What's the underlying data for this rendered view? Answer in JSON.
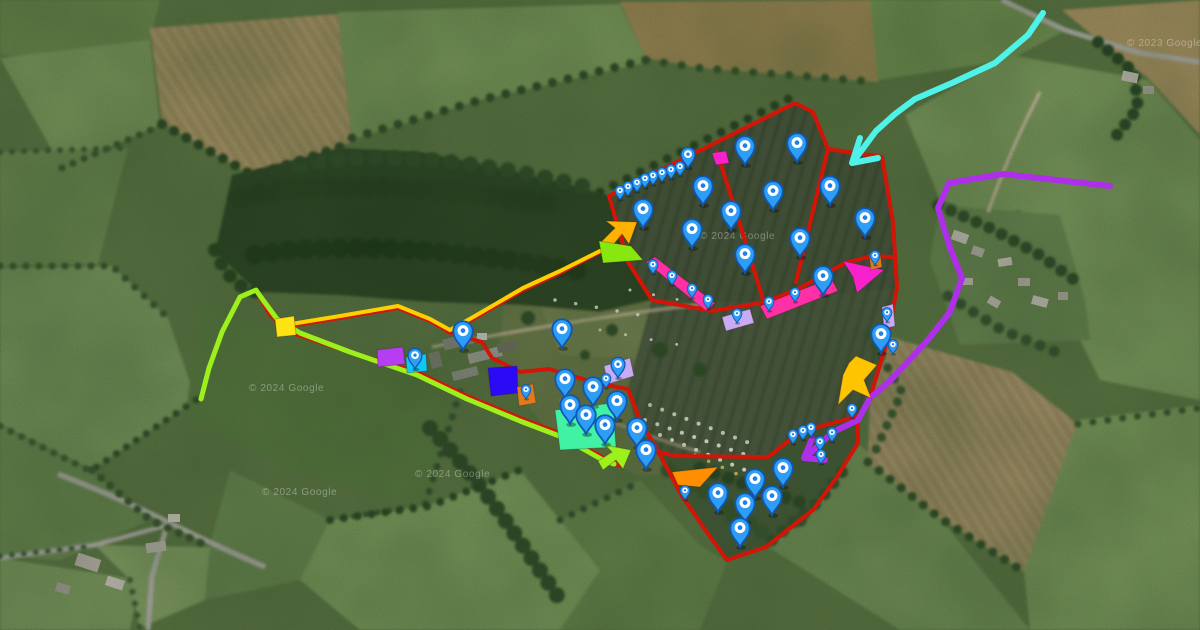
{
  "map": {
    "watermarks": [
      {
        "text": "© 2024 Google",
        "x": 249,
        "y": 391
      },
      {
        "text": "© 2024 Google",
        "x": 415,
        "y": 477
      },
      {
        "text": "© 2024 Google",
        "x": 700,
        "y": 239
      },
      {
        "text": "© 2024 Google",
        "x": 262,
        "y": 495
      },
      {
        "text": "© 2023 Google",
        "x": 1127,
        "y": 46
      }
    ],
    "watermark_color": "#ffffff",
    "routes": [
      {
        "id": "boundary-main-field",
        "color": "#d21507",
        "width": 4,
        "points": [
          [
            609,
            196
          ],
          [
            795,
            103
          ],
          [
            813,
            112
          ],
          [
            828,
            149
          ],
          [
            882,
            157
          ],
          [
            893,
            222
          ],
          [
            897,
            288
          ],
          [
            886,
            345
          ],
          [
            870,
            398
          ],
          [
            858,
            421
          ]
        ]
      },
      {
        "id": "boundary-left-edge",
        "color": "#d21507",
        "width": 4,
        "points": [
          [
            609,
            196
          ],
          [
            628,
            262
          ],
          [
            652,
            300
          ]
        ]
      },
      {
        "id": "boundary-divider-west",
        "color": "#d21507",
        "width": 4,
        "points": [
          [
            717,
            152
          ],
          [
            748,
            250
          ],
          [
            764,
            303
          ]
        ]
      },
      {
        "id": "boundary-divider-east",
        "color": "#d21507",
        "width": 4,
        "points": [
          [
            828,
            149
          ],
          [
            812,
            215
          ],
          [
            796,
            282
          ]
        ]
      },
      {
        "id": "boundary-belt",
        "color": "#d21507",
        "width": 4,
        "points": [
          [
            652,
            300
          ],
          [
            712,
            311
          ],
          [
            766,
            302
          ],
          [
            800,
            288
          ],
          [
            845,
            263
          ],
          [
            872,
            256
          ],
          [
            893,
            257
          ]
        ]
      },
      {
        "id": "boundary-access-north",
        "color": "#d21507",
        "width": 4,
        "points": [
          [
            257,
            292
          ],
          [
            270,
            315
          ],
          [
            283,
            327
          ],
          [
            340,
            318
          ],
          [
            398,
            308
          ],
          [
            430,
            321
          ],
          [
            450,
            332
          ],
          [
            475,
            318
          ],
          [
            523,
            290
          ],
          [
            560,
            273
          ],
          [
            598,
            253
          ],
          [
            616,
            245
          ]
        ]
      },
      {
        "id": "boundary-farm-south",
        "color": "#d21507",
        "width": 4,
        "points": [
          [
            283,
            330
          ],
          [
            340,
            349
          ],
          [
            417,
            372
          ],
          [
            467,
            396
          ],
          [
            520,
            418
          ],
          [
            562,
            434
          ],
          [
            600,
            456
          ],
          [
            620,
            466
          ]
        ]
      },
      {
        "id": "boundary-farm-east",
        "color": "#d21507",
        "width": 4,
        "points": [
          [
            448,
            332
          ],
          [
            482,
            342
          ],
          [
            492,
            358
          ],
          [
            520,
            372
          ],
          [
            549,
            369
          ],
          [
            600,
            384
          ],
          [
            628,
            389
          ],
          [
            640,
            420
          ],
          [
            660,
            455
          ],
          [
            682,
            496
          ],
          [
            706,
            531
          ],
          [
            727,
            560
          ],
          [
            766,
            547
          ],
          [
            790,
            528
          ],
          [
            813,
            510
          ],
          [
            837,
            477
          ],
          [
            858,
            443
          ],
          [
            858,
            418
          ]
        ]
      },
      {
        "id": "boundary-lower-field-top",
        "color": "#d21507",
        "width": 4,
        "points": [
          [
            640,
            447
          ],
          [
            675,
            456
          ],
          [
            768,
            457
          ],
          [
            800,
            432
          ],
          [
            858,
            416
          ]
        ]
      },
      {
        "id": "route-cyan",
        "color": "#4ff2e9",
        "width": 6,
        "points": [
          [
            1043,
            13
          ],
          [
            1028,
            35
          ],
          [
            995,
            63
          ],
          [
            952,
            83
          ],
          [
            915,
            99
          ],
          [
            895,
            114
          ],
          [
            876,
            131
          ],
          [
            856,
            158
          ]
        ],
        "head": [
          [
            860,
            138
          ],
          [
            852,
            163
          ],
          [
            878,
            158
          ]
        ]
      },
      {
        "id": "route-purple",
        "color": "#ad2fe9",
        "width": 6,
        "points": [
          [
            1110,
            186
          ],
          [
            1003,
            174
          ],
          [
            949,
            183
          ],
          [
            938,
            208
          ],
          [
            950,
            248
          ],
          [
            962,
            278
          ],
          [
            950,
            312
          ],
          [
            927,
            341
          ],
          [
            890,
            381
          ],
          [
            870,
            398
          ],
          [
            858,
            420
          ],
          [
            833,
            432
          ],
          [
            808,
            455
          ]
        ],
        "head": [
          [
            812,
            439
          ],
          [
            804,
            458
          ],
          [
            825,
            460
          ]
        ]
      },
      {
        "id": "route-yellow",
        "color": "#ffd000",
        "width": 4,
        "points": [
          [
            285,
            325
          ],
          [
            340,
            316
          ],
          [
            398,
            306
          ],
          [
            430,
            319
          ],
          [
            450,
            330
          ],
          [
            475,
            316
          ],
          [
            523,
            288
          ],
          [
            560,
            271
          ],
          [
            600,
            251
          ]
        ]
      },
      {
        "id": "route-lime",
        "color": "#9df01c",
        "width": 5,
        "points": [
          [
            201,
            399
          ],
          [
            209,
            368
          ],
          [
            222,
            332
          ],
          [
            240,
            297
          ],
          [
            256,
            290
          ],
          [
            263,
            300
          ],
          [
            277,
            319
          ],
          [
            300,
            333
          ],
          [
            350,
            352
          ],
          [
            417,
            375
          ],
          [
            467,
            399
          ],
          [
            520,
            421
          ],
          [
            562,
            437
          ],
          [
            601,
            459
          ],
          [
            614,
            464
          ]
        ]
      }
    ],
    "zones": [
      {
        "id": "zone-yellow-gate",
        "color": "#ffe212",
        "points": [
          [
            275,
            319
          ],
          [
            294,
            316
          ],
          [
            296,
            335
          ],
          [
            277,
            337
          ]
        ]
      },
      {
        "id": "zone-purple-rect",
        "color": "#b43ef0",
        "points": [
          [
            377,
            350
          ],
          [
            403,
            347
          ],
          [
            405,
            364
          ],
          [
            378,
            367
          ]
        ]
      },
      {
        "id": "zone-cyan-rect",
        "color": "#0fc8f7",
        "points": [
          [
            406,
            357
          ],
          [
            426,
            354
          ],
          [
            427,
            371
          ],
          [
            407,
            373
          ]
        ]
      },
      {
        "id": "zone-blue-rect",
        "color": "#2b0af5",
        "points": [
          [
            488,
            368
          ],
          [
            517,
            366
          ],
          [
            518,
            393
          ],
          [
            491,
            396
          ]
        ]
      },
      {
        "id": "zone-orange-small-west",
        "color": "#e07b1d",
        "points": [
          [
            517,
            387
          ],
          [
            533,
            384
          ],
          [
            536,
            403
          ],
          [
            519,
            406
          ]
        ]
      },
      {
        "id": "zone-mint-rect",
        "color": "#41f1a4",
        "points": [
          [
            555,
            410
          ],
          [
            613,
            403
          ],
          [
            616,
            447
          ],
          [
            560,
            450
          ]
        ]
      },
      {
        "id": "zone-lavender-farm",
        "color": "#c9abf5",
        "points": [
          [
            604,
            366
          ],
          [
            630,
            358
          ],
          [
            634,
            376
          ],
          [
            608,
            384
          ]
        ]
      },
      {
        "id": "zone-magenta-top",
        "color": "#f822cd",
        "points": [
          [
            712,
            153
          ],
          [
            726,
            151
          ],
          [
            729,
            163
          ],
          [
            716,
            165
          ]
        ]
      },
      {
        "id": "zone-pink-bar-west",
        "color": "#ff2fa6",
        "points": [
          [
            646,
            262
          ],
          [
            655,
            257
          ],
          [
            715,
            303
          ],
          [
            706,
            311
          ]
        ]
      },
      {
        "id": "zone-pink-bar-east",
        "color": "#ff2fa6",
        "points": [
          [
            760,
            306
          ],
          [
            831,
            278
          ],
          [
            838,
            291
          ],
          [
            767,
            319
          ]
        ]
      },
      {
        "id": "zone-lavender-mid",
        "color": "#c9abf5",
        "points": [
          [
            722,
            317
          ],
          [
            750,
            309
          ],
          [
            754,
            323
          ],
          [
            726,
            331
          ]
        ]
      },
      {
        "id": "zone-magenta-arrow",
        "color": "#f822cd",
        "points": [
          [
            843,
            261
          ],
          [
            884,
            270
          ],
          [
            857,
            293
          ],
          [
            853,
            277
          ]
        ]
      },
      {
        "id": "zone-orange-small-east",
        "color": "#e07b1d",
        "points": [
          [
            869,
            254
          ],
          [
            880,
            252
          ],
          [
            882,
            267
          ],
          [
            871,
            270
          ]
        ]
      },
      {
        "id": "zone-lavender-east",
        "color": "#c9abf5",
        "points": [
          [
            882,
            307
          ],
          [
            893,
            304
          ],
          [
            895,
            326
          ],
          [
            884,
            329
          ]
        ]
      },
      {
        "id": "zone-yellow-arrow-flag",
        "color": "#ffc400",
        "points": [
          [
            856,
            356
          ],
          [
            877,
            365
          ],
          [
            864,
            380
          ],
          [
            871,
            398
          ],
          [
            853,
            390
          ],
          [
            838,
            405
          ],
          [
            843,
            375
          ],
          [
            849,
            363
          ]
        ]
      },
      {
        "id": "zone-orange-triangle",
        "color": "#ff8f00",
        "points": [
          [
            672,
            472
          ],
          [
            718,
            467
          ],
          [
            700,
            487
          ],
          [
            678,
            485
          ]
        ]
      },
      {
        "id": "zone-arrow-northeast",
        "color": "#ffb300",
        "points": [
          [
            637,
            222
          ],
          [
            629,
            244
          ],
          [
            622,
            234
          ],
          [
            609,
            250
          ],
          [
            601,
            242
          ],
          [
            615,
            228
          ],
          [
            606,
            221
          ]
        ]
      },
      {
        "id": "zone-lime-flag",
        "color": "#86e80e",
        "points": [
          [
            599,
            241
          ],
          [
            631,
            246
          ],
          [
            643,
            260
          ],
          [
            603,
            263
          ]
        ]
      },
      {
        "id": "zone-lime-arrow-mid",
        "color": "#9df01c",
        "points": [
          [
            631,
            450
          ],
          [
            623,
            469
          ],
          [
            616,
            460
          ],
          [
            603,
            470
          ],
          [
            598,
            461
          ],
          [
            612,
            452
          ],
          [
            605,
            445
          ]
        ]
      }
    ],
    "pins": {
      "large": [
        [
          703,
          205
        ],
        [
          745,
          165
        ],
        [
          797,
          162
        ],
        [
          773,
          210
        ],
        [
          830,
          205
        ],
        [
          643,
          228
        ],
        [
          731,
          230
        ],
        [
          865,
          237
        ],
        [
          692,
          248
        ],
        [
          800,
          257
        ],
        [
          745,
          273
        ],
        [
          823,
          295
        ],
        [
          463,
          350
        ],
        [
          562,
          348
        ],
        [
          565,
          398
        ],
        [
          593,
          406
        ],
        [
          617,
          420
        ],
        [
          637,
          447
        ],
        [
          646,
          469
        ],
        [
          570,
          424
        ],
        [
          586,
          434
        ],
        [
          605,
          444
        ],
        [
          881,
          353
        ],
        [
          718,
          512
        ],
        [
          745,
          522
        ],
        [
          755,
          498
        ],
        [
          772,
          515
        ],
        [
          783,
          487
        ],
        [
          740,
          547
        ]
      ],
      "medium": [
        [
          688,
          168
        ],
        [
          618,
          378
        ],
        [
          415,
          369
        ]
      ],
      "small": [
        [
          620,
          200
        ],
        [
          628,
          196
        ],
        [
          637,
          192
        ],
        [
          645,
          188
        ],
        [
          653,
          185
        ],
        [
          662,
          182
        ],
        [
          671,
          179
        ],
        [
          680,
          176
        ],
        [
          653,
          274
        ],
        [
          672,
          285
        ],
        [
          692,
          298
        ],
        [
          708,
          309
        ],
        [
          769,
          311
        ],
        [
          795,
          302
        ],
        [
          823,
          292
        ],
        [
          737,
          323
        ],
        [
          875,
          265
        ],
        [
          887,
          322
        ],
        [
          893,
          354
        ],
        [
          793,
          444
        ],
        [
          803,
          440
        ],
        [
          811,
          437
        ],
        [
          820,
          451
        ],
        [
          832,
          442
        ],
        [
          821,
          464
        ],
        [
          852,
          418
        ],
        [
          526,
          399
        ],
        [
          606,
          388
        ],
        [
          685,
          500
        ]
      ]
    },
    "pin_style": {
      "body": "#2e9df5",
      "rim": "#0f57b4",
      "center": "#ffffff",
      "dot": "#1f7fe8"
    }
  }
}
